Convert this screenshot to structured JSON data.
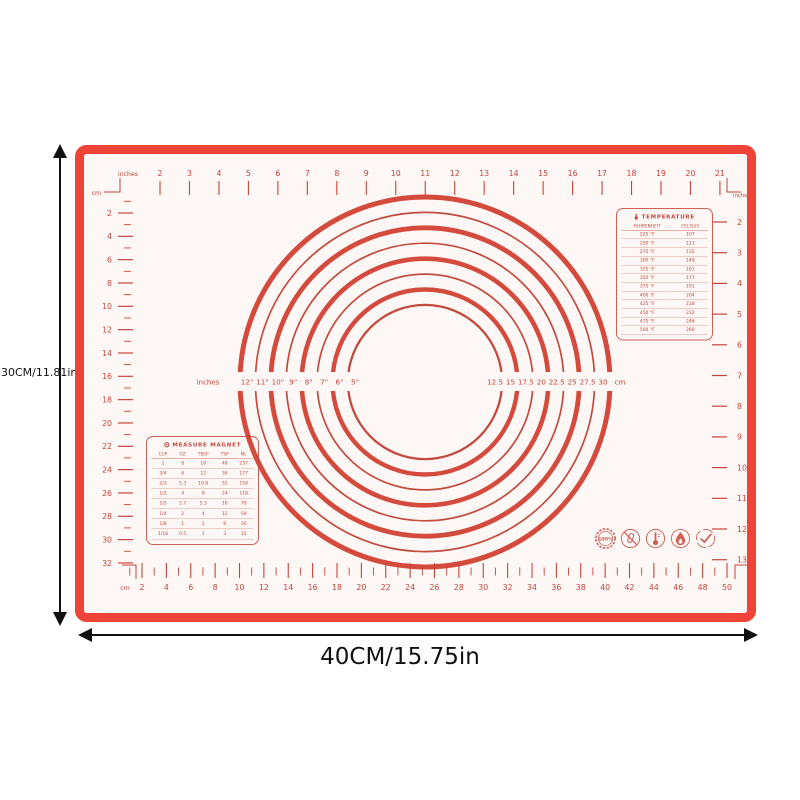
{
  "colors": {
    "mat_border": "#ee4337",
    "print_red": "#c4453b",
    "ring_thick": "#d44a3c",
    "ring_thin": "#c24a3e",
    "mat_bg": "#fdf8f5",
    "arrow_black": "#111111"
  },
  "dimension_labels": {
    "height": "30CM/11.81in",
    "width": "40CM/15.75in"
  },
  "rulers": {
    "top": {
      "left_unit": "inches",
      "corner_unit": "cm",
      "right_unit": "inches",
      "labels": [
        2,
        3,
        4,
        5,
        6,
        7,
        8,
        9,
        10,
        11,
        12,
        13,
        14,
        15,
        16,
        17,
        18,
        19,
        20,
        21
      ]
    },
    "left": {
      "labels": [
        2,
        4,
        6,
        8,
        10,
        12,
        14,
        16,
        18,
        20,
        22,
        24,
        26,
        28,
        30,
        32
      ]
    },
    "right": {
      "labels": [
        2,
        3,
        4,
        5,
        6,
        7,
        8,
        9,
        10,
        11,
        12,
        13
      ]
    },
    "bottom": {
      "unit": "cm",
      "labels": [
        2,
        4,
        6,
        8,
        10,
        12,
        14,
        16,
        18,
        20,
        22,
        24,
        26,
        28,
        30,
        32,
        34,
        36,
        38,
        40,
        42,
        44,
        46,
        48,
        50
      ]
    }
  },
  "circles": {
    "left_unit": "inches",
    "right_unit": "cm",
    "diameters_in": [
      12,
      11,
      10,
      9,
      8,
      7,
      6,
      5
    ],
    "inch_labels": [
      "12\"",
      "11\"",
      "10\"",
      "9\"",
      "8\"",
      "7\"",
      "6\"",
      "5\""
    ],
    "cm_labels": [
      "12.5",
      "15",
      "17.5",
      "20",
      "22.5",
      "25",
      "27.5",
      "30"
    ]
  },
  "temperature_table": {
    "title": "TEMPERATURE",
    "columns": [
      "FAHRENHEIT",
      "CELSIUS"
    ],
    "rows": [
      [
        "225 °F",
        "107"
      ],
      [
        "250 °F",
        "121"
      ],
      [
        "275 °F",
        "135"
      ],
      [
        "300 °F",
        "149"
      ],
      [
        "325 °F",
        "163"
      ],
      [
        "350 °F",
        "177"
      ],
      [
        "375 °F",
        "191"
      ],
      [
        "400 °F",
        "204"
      ],
      [
        "425 °F",
        "218"
      ],
      [
        "450 °F",
        "232"
      ],
      [
        "475 °F",
        "246"
      ],
      [
        "500 °F",
        "260"
      ]
    ]
  },
  "measure_table": {
    "title": "MEASURE MAGNET",
    "columns": [
      "CUP",
      "OZ",
      "TBSP",
      "TSP",
      "ML"
    ],
    "rows": [
      [
        "1",
        "8",
        "16",
        "48",
        "237"
      ],
      [
        "3/4",
        "6",
        "12",
        "36",
        "177"
      ],
      [
        "2/3",
        "5.3",
        "10.6",
        "32",
        "158"
      ],
      [
        "1/2",
        "4",
        "8",
        "24",
        "118"
      ],
      [
        "1/3",
        "2.7",
        "5.3",
        "16",
        "79"
      ],
      [
        "1/4",
        "2",
        "4",
        "12",
        "59"
      ],
      [
        "1/8",
        "1",
        "2",
        "6",
        "30"
      ],
      [
        "1/16",
        "0.5",
        "1",
        "3",
        "15"
      ]
    ]
  },
  "badges": [
    {
      "name": "badge-100-percent",
      "label": "100%"
    },
    {
      "name": "no-bpa-icon"
    },
    {
      "name": "thermometer-badge-icon"
    },
    {
      "name": "flame-icon"
    },
    {
      "name": "check-icon"
    }
  ]
}
